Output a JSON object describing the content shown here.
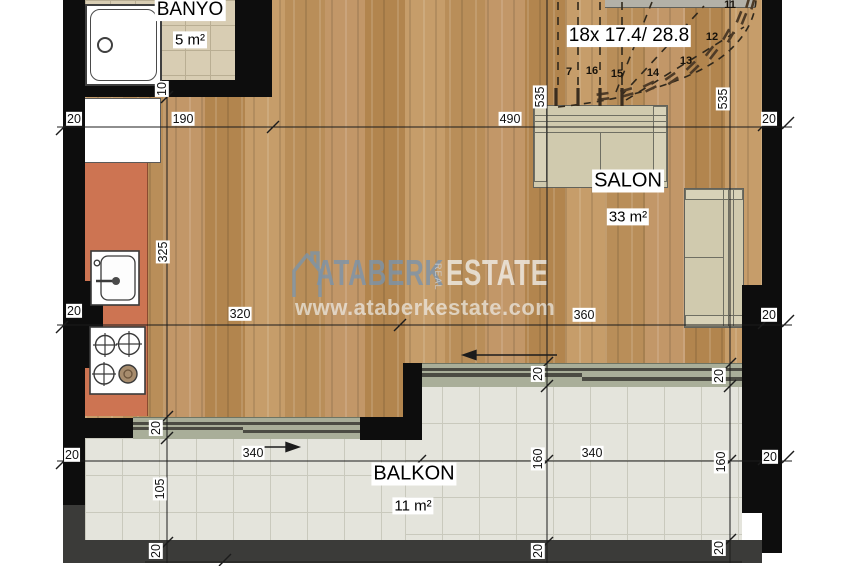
{
  "rooms": {
    "banyo": {
      "name": "BANYO",
      "area": "5 m²"
    },
    "salon": {
      "name": "SALON",
      "area": "33 m²"
    },
    "balkon": {
      "name": "BALKON",
      "area": "11 m²"
    }
  },
  "stairs": {
    "label": "18x 17.4/ 28.8",
    "steps": [
      "7",
      "16",
      "15",
      "14",
      "13",
      "12",
      "11"
    ]
  },
  "dims": [
    "20",
    "190",
    "490",
    "20",
    "10",
    "535",
    "535",
    "20",
    "320",
    "360",
    "20",
    "325",
    "20",
    "340",
    "340",
    "20",
    "160",
    "160",
    "20",
    "20",
    "20",
    "105",
    "20",
    "20",
    "20"
  ],
  "watermark": {
    "brand": "ATABERK",
    "mid": "REAL",
    "suffix": "ESTATE",
    "url": "www.ataberkestate.com"
  },
  "colors": {
    "wall": "#0d0d0d",
    "outer_wall": "#3b3b39",
    "kitchen_counter": "#cd7452",
    "wood_floor": "#bd9361",
    "furniture": "#d0caae",
    "banyo_tile": "#d8cdb3",
    "balcony_tile": "#e4e4dc",
    "door_sill": "#a9ae99",
    "watermark_blue": "#7d96ad"
  }
}
